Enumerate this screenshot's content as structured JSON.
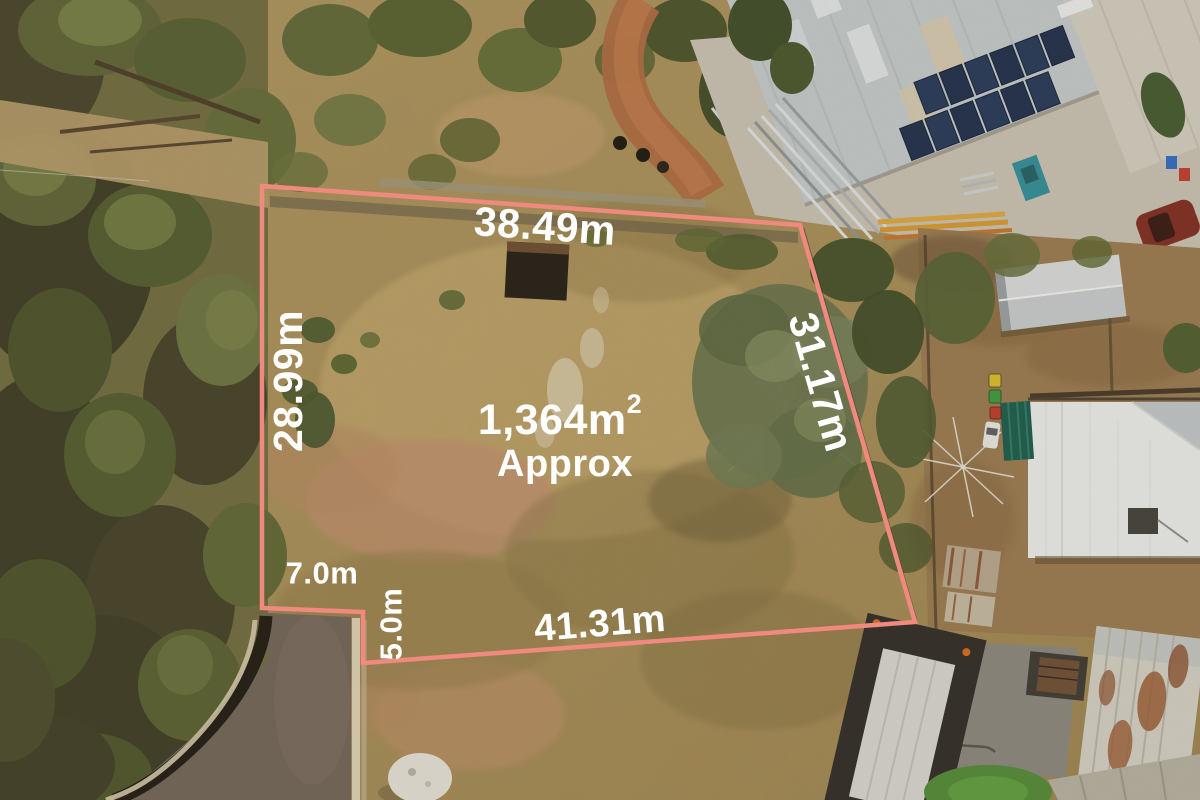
{
  "overlay": {
    "boundary_color": "#f0897e",
    "label_color": "#ffffff",
    "dim_top": "38.49m",
    "dim_left": "28.99m",
    "dim_right": "31.17m",
    "dim_bottom": "41.31m",
    "dim_notch_width": "7.0m",
    "dim_notch_depth": "5.0m",
    "area_value": "1,364m",
    "area_superscript": "2",
    "area_qualifier": "Approx"
  },
  "scene": {
    "type": "aerial-drone-photo",
    "palette": {
      "dry_grass": "#b49a62",
      "dirt_pink": "#c39070",
      "bush_green": "#5c6334",
      "red_track": "#b06a40",
      "industrial_roof": "#c5ccd0",
      "solar_panel": "#22355a",
      "house_roof_white": "#eef0f1",
      "asphalt": "#70645a",
      "kerb": "#e0d5b6",
      "lawn": "#4f8a36"
    }
  }
}
